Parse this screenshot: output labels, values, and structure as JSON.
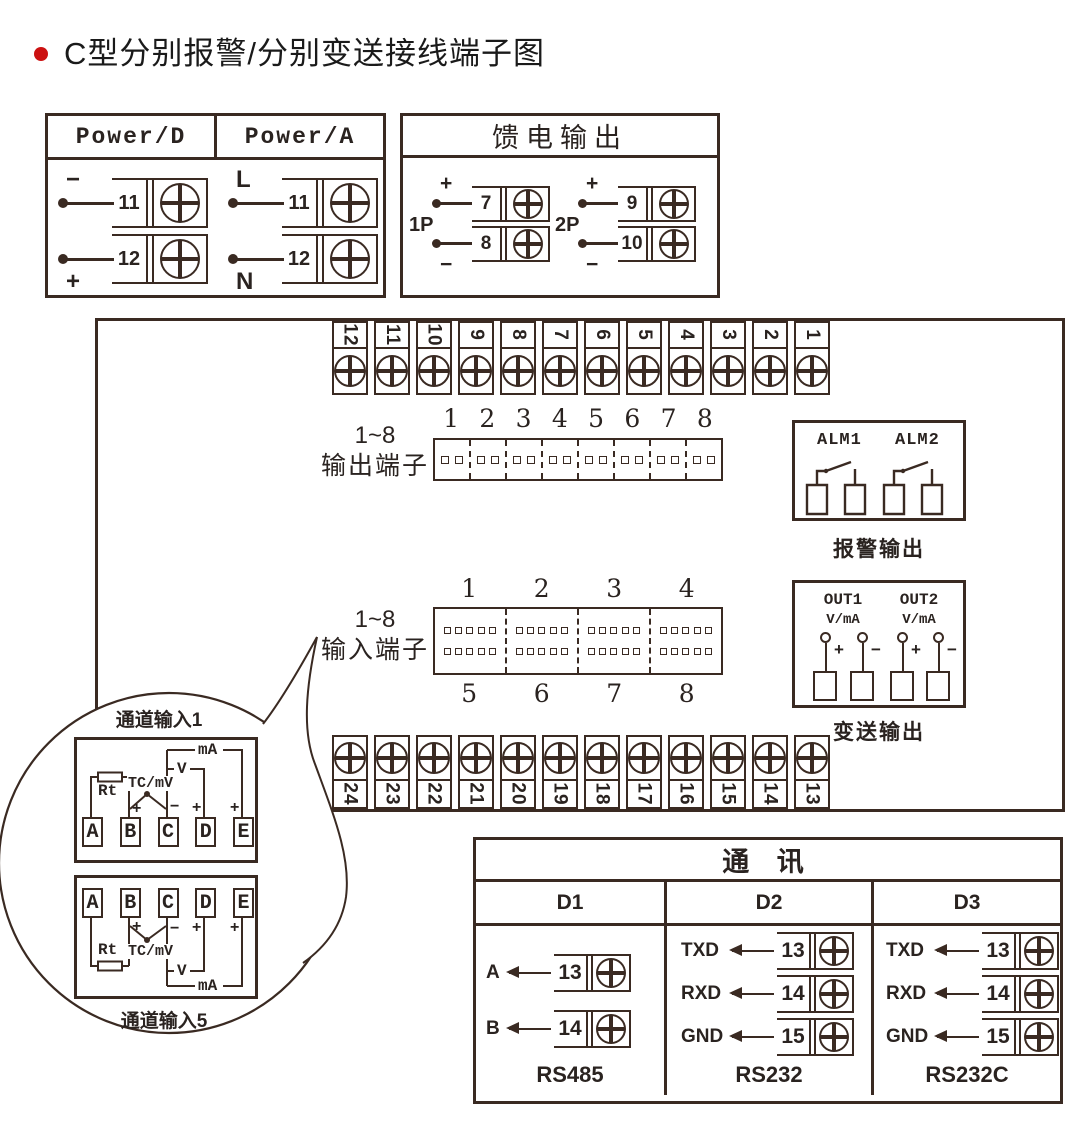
{
  "title": {
    "text": "C型分别报警/分别变送接线端子图"
  },
  "colors": {
    "line": "#3a2a22",
    "bullet_red": "#cc1111",
    "background": "#ffffff"
  },
  "power_box": {
    "columns": [
      {
        "header": "Power/D",
        "terminals": [
          {
            "sign": "−",
            "sign_pos": "above",
            "num": "11"
          },
          {
            "sign": "+",
            "sign_pos": "below",
            "num": "12"
          }
        ]
      },
      {
        "header": "Power/A",
        "terminals": [
          {
            "sign": "L",
            "sign_pos": "above",
            "num": "11"
          },
          {
            "sign": "N",
            "sign_pos": "below",
            "num": "12"
          }
        ]
      }
    ]
  },
  "feed_box": {
    "header": "馈电输出",
    "groups": [
      {
        "label": "1P",
        "terminals": [
          {
            "sign": "+",
            "sign_pos": "above",
            "num": "7"
          },
          {
            "sign": "−",
            "sign_pos": "below",
            "num": "8"
          }
        ]
      },
      {
        "label": "2P",
        "terminals": [
          {
            "sign": "+",
            "sign_pos": "above",
            "num": "9"
          },
          {
            "sign": "−",
            "sign_pos": "below",
            "num": "10"
          }
        ]
      }
    ]
  },
  "main_box": {
    "top_strip": [
      "12",
      "11",
      "10",
      "9",
      "8",
      "7",
      "6",
      "5",
      "4",
      "3",
      "2",
      "1"
    ],
    "bottom_strip": [
      "24",
      "23",
      "22",
      "21",
      "20",
      "19",
      "18",
      "17",
      "16",
      "15",
      "14",
      "13"
    ],
    "output_block": {
      "label_line1": "1~8",
      "label_line2": "输出端子",
      "numbers": [
        "1",
        "2",
        "3",
        "4",
        "5",
        "6",
        "7",
        "8"
      ]
    },
    "input_block": {
      "label_line1": "1~8",
      "label_line2": "输入端子",
      "numbers_top": [
        "1",
        "2",
        "3",
        "4"
      ],
      "numbers_bottom": [
        "5",
        "6",
        "7",
        "8"
      ]
    },
    "alarm_box": {
      "labels": [
        "ALM1",
        "ALM2"
      ],
      "caption": "报警输出"
    },
    "out_box": {
      "channels": [
        {
          "name": "OUT1",
          "unit": "V/mA"
        },
        {
          "name": "OUT2",
          "unit": "V/mA"
        }
      ],
      "plus": "+",
      "minus": "−",
      "caption": "变送输出"
    }
  },
  "callout": {
    "top_label": "通道输入1",
    "bottom_label": "通道输入5",
    "terminals": [
      "A",
      "B",
      "C",
      "D",
      "E"
    ],
    "signs": [
      "+",
      "−",
      "+",
      "+"
    ],
    "wiring": {
      "rt": "Rt",
      "tc": "TC/mV",
      "v": "V",
      "ma": "mA"
    }
  },
  "comm_box": {
    "header": "通 讯",
    "columns": [
      {
        "name": "D1",
        "caption": "RS485",
        "rows": [
          {
            "label": "A",
            "num": "13"
          },
          {
            "label": "B",
            "num": "14"
          }
        ]
      },
      {
        "name": "D2",
        "caption": "RS232",
        "rows": [
          {
            "label": "TXD",
            "num": "13"
          },
          {
            "label": "RXD",
            "num": "14"
          },
          {
            "label": "GND",
            "num": "15"
          }
        ]
      },
      {
        "name": "D3",
        "caption": "RS232C",
        "rows": [
          {
            "label": "TXD",
            "num": "13"
          },
          {
            "label": "RXD",
            "num": "14"
          },
          {
            "label": "GND",
            "num": "15"
          }
        ]
      }
    ]
  }
}
